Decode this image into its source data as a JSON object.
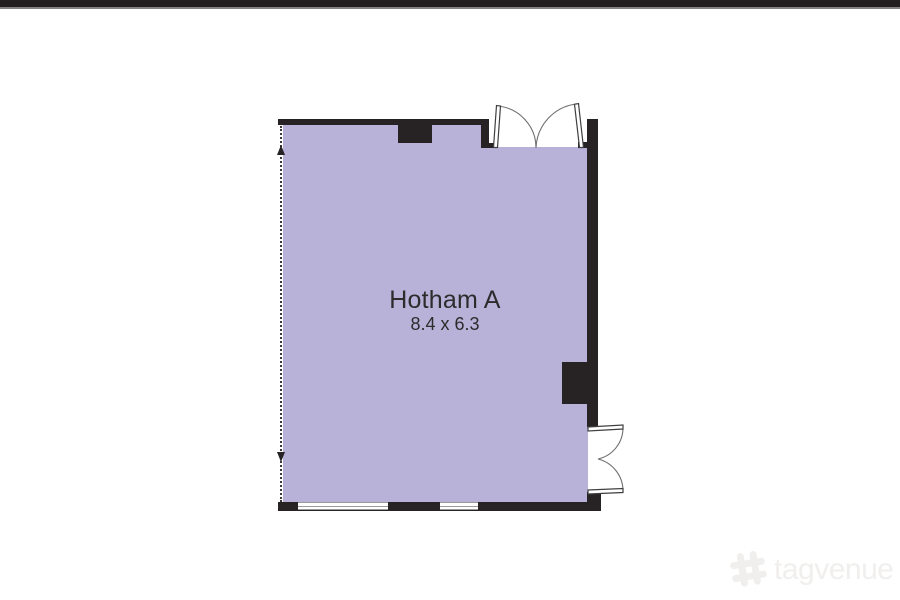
{
  "page": {
    "background_color": "#ffffff"
  },
  "top_bar": {
    "color": "#231f20",
    "underline_color": "#838383"
  },
  "floor_plan": {
    "room": {
      "name": "Hotham A",
      "dimensions": "8.4 x 6.3"
    },
    "colors": {
      "room_fill": "#b8b2d9",
      "wall": "#272223",
      "label_text": "#2d2b2c",
      "door_outline": "#3f3f3f",
      "door_arc": "#707070",
      "window_line": "#9b9b9b",
      "dimension_line": "#3a3a3a"
    },
    "features": {
      "doors": [
        {
          "location": "top-right",
          "type": "double-swing",
          "swing": "inward"
        },
        {
          "location": "bottom-right",
          "type": "double-swing",
          "swing": "outward"
        }
      ],
      "windows": [
        {
          "location": "bottom-wall-left"
        },
        {
          "location": "bottom-wall-center"
        }
      ],
      "columns": [
        {
          "location": "top-wall"
        },
        {
          "location": "right-wall-pier"
        }
      ],
      "dimension_arrows": {
        "location": "left-edge",
        "orientation": "vertical"
      }
    }
  },
  "watermark": {
    "text": "tagvenue",
    "color": "#f0efed"
  }
}
